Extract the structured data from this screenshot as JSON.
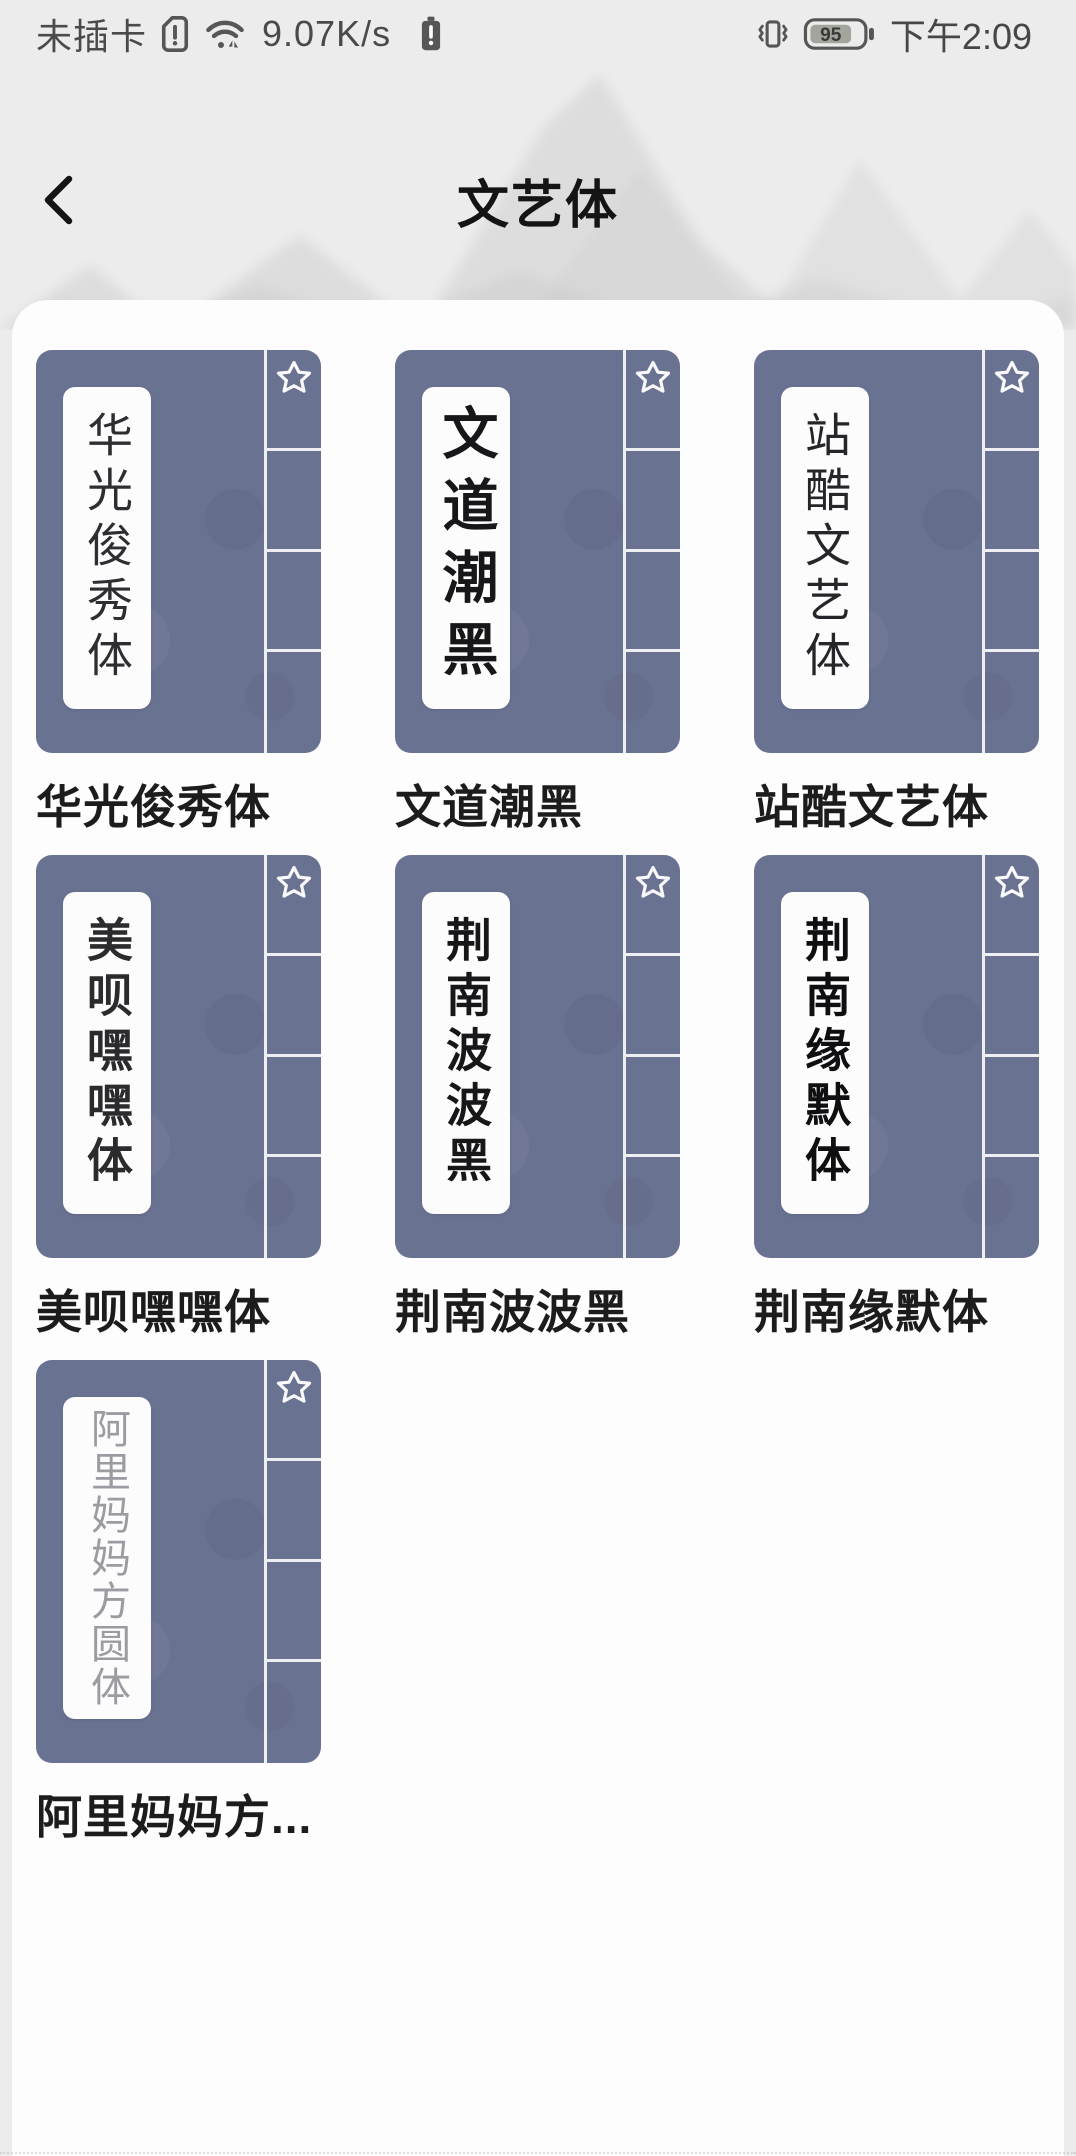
{
  "status_bar": {
    "no_sim": "未插卡",
    "speed": "9.07K/s",
    "battery_percent": "95",
    "time": "下午2:09"
  },
  "header": {
    "title": "文艺体"
  },
  "fonts": [
    {
      "spine": "华光俊秀体",
      "label": "华光俊秀体",
      "style": "serif"
    },
    {
      "spine": "文道潮黑",
      "label": "文道潮黑",
      "style": "bold"
    },
    {
      "spine": "站酷文艺体",
      "label": "站酷文艺体",
      "style": "regular"
    },
    {
      "spine": "美呗嘿嘿体",
      "label": "美呗嘿嘿体",
      "style": "deco"
    },
    {
      "spine": "荆南波波黑",
      "label": "荆南波波黑",
      "style": "bold"
    },
    {
      "spine": "荆南缘默体",
      "label": "荆南缘默体",
      "style": "heavy"
    },
    {
      "spine": "阿里妈妈方圆体",
      "label": "阿里妈妈方...",
      "style": "thin"
    }
  ],
  "icons": {
    "sim_alert": "sim-alert-icon",
    "wifi": "wifi-icon",
    "battery_alert": "battery-alert-icon",
    "vibrate": "vibrate-icon",
    "battery": "battery-icon",
    "back": "back-chevron-icon",
    "favorite": "favorite-star-icon"
  },
  "colors": {
    "card_bg": "#6a7292",
    "panel_bg": "#fdfdfe",
    "page_bg": "#ececec",
    "divider_white": "#fafafc",
    "label_text": "#1c1c1c"
  }
}
